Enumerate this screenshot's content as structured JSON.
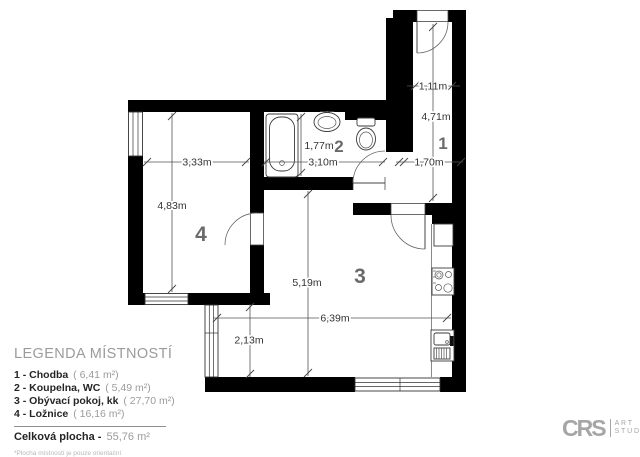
{
  "plan": {
    "rooms": [
      {
        "number": "1"
      },
      {
        "number": "2"
      },
      {
        "number": "3"
      },
      {
        "number": "4"
      }
    ],
    "dimensions": [
      {
        "id": "hall-width",
        "label": "1,11m"
      },
      {
        "id": "hall-length",
        "label": "4,71m"
      },
      {
        "id": "hall-passage",
        "label": "1,70m"
      },
      {
        "id": "bath-depth",
        "label": "1,77m"
      },
      {
        "id": "bath-width",
        "label": "3,10m"
      },
      {
        "id": "bedroom-width",
        "label": "3,33m"
      },
      {
        "id": "bedroom-length",
        "label": "4,83m"
      },
      {
        "id": "living-length",
        "label": "5,19m"
      },
      {
        "id": "living-width",
        "label": "6,39m"
      },
      {
        "id": "living-nook",
        "label": "2,13m"
      }
    ]
  },
  "legend": {
    "title": "LEGENDA MÍSTNOSTÍ",
    "items": [
      {
        "name": "1 - Chodba",
        "area": "( 6,41 m²)"
      },
      {
        "name": "2 - Koupelna, WC",
        "area": "( 5,49 m²)"
      },
      {
        "name": "3 - Obývací pokoj, kk",
        "area": "( 27,70 m²)"
      },
      {
        "name": "4 - Ložnice",
        "area": "( 16,16 m²)"
      }
    ],
    "total_label": "Celková plocha -",
    "total_value": "55,76 m²",
    "footnote": "*Plocha místností je pouze orientační"
  },
  "logo": {
    "brand": "CRS",
    "line1": "ART",
    "line2": "STUDIO"
  },
  "colors": {
    "wall": "#000000",
    "line": "#555555",
    "label_gray": "#9b9b9b",
    "text_dark": "#252525"
  }
}
